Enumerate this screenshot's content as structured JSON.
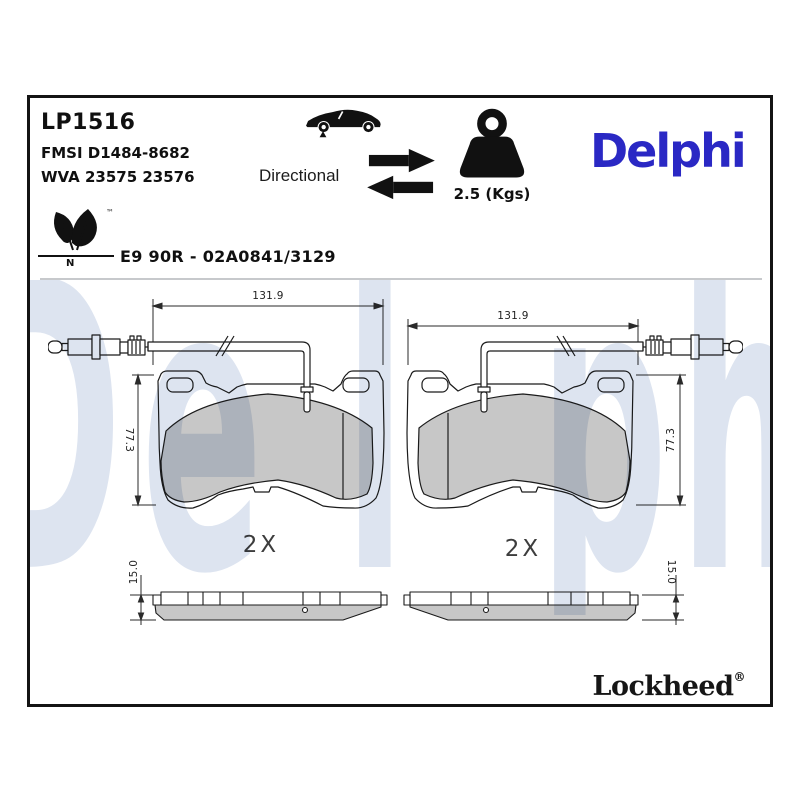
{
  "header": {
    "part_number": "LP1516",
    "fmsi_ref": "FMSI D1484-8682",
    "wva_ref": "WVA 23575 23576",
    "directional_label": "Directional",
    "weight_value": "2.5 (Kgs)",
    "brand_logo": "Delphi",
    "eco_trademark": "™",
    "eco_letter": "N",
    "homologation": "E9 90R - 02A0841/3129"
  },
  "watermark": {
    "text": "Delphi",
    "letters": [
      "D",
      "e",
      "l",
      "p",
      "h",
      "i"
    ]
  },
  "drawings": {
    "left_pad": {
      "width_dim": "131.9",
      "height_dim": "77.3",
      "quantity": "2X",
      "thickness_dim": "15.0"
    },
    "right_pad": {
      "width_dim": "131.9",
      "height_dim": "77.3",
      "quantity": "2X",
      "thickness_dim": "15.0"
    }
  },
  "footer": {
    "brand_logo": "Lockheed",
    "registered_mark": "®"
  },
  "colors": {
    "brand_blue": "#2A28C4",
    "watermark_blue": "#DDE4F0",
    "friction_gray": "#C7C7C7",
    "line_dark": "#1B1B1B"
  }
}
